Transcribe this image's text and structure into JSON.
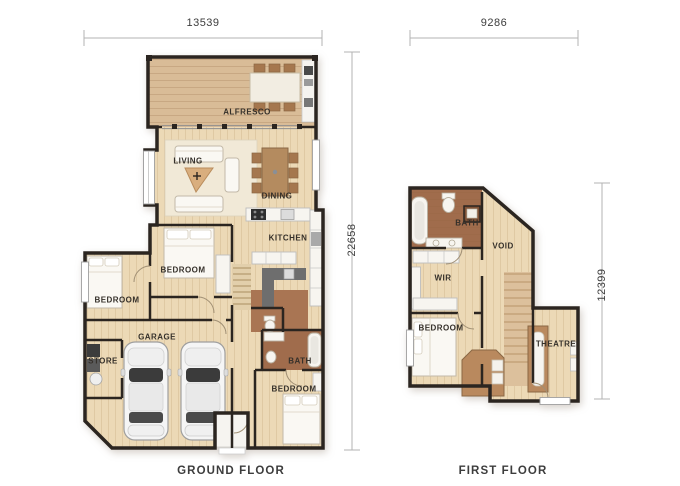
{
  "sheet": {
    "background": "#ffffff"
  },
  "ground_floor": {
    "label": "GROUND FLOOR",
    "dimensions": {
      "width": "13539",
      "height": "22658"
    },
    "rooms": [
      {
        "name": "ALFRESCO"
      },
      {
        "name": "LIVING"
      },
      {
        "name": "DINING"
      },
      {
        "name": "KITCHEN"
      },
      {
        "name": "BEDROOM"
      },
      {
        "name": "BEDROOM"
      },
      {
        "name": "GARAGE"
      },
      {
        "name": "STORE"
      },
      {
        "name": "BATH"
      },
      {
        "name": "BEDROOM"
      }
    ]
  },
  "first_floor": {
    "label": "FIRST FLOOR",
    "dimensions": {
      "width": "9286",
      "height": "12399"
    },
    "rooms": [
      {
        "name": "BATH"
      },
      {
        "name": "VOID"
      },
      {
        "name": "WIR"
      },
      {
        "name": "BEDROOM"
      },
      {
        "name": "THEATRE"
      }
    ]
  },
  "colors": {
    "wall": "#2b2520",
    "wood_floor": "#ecd9b6",
    "deck": "#d9bc97",
    "tile_brown": "#a06c4c",
    "hall_brown": "#a97553",
    "landing_brown": "#b9895e",
    "dim_line": "#b3b3b3",
    "text": "#3c3c3c"
  }
}
